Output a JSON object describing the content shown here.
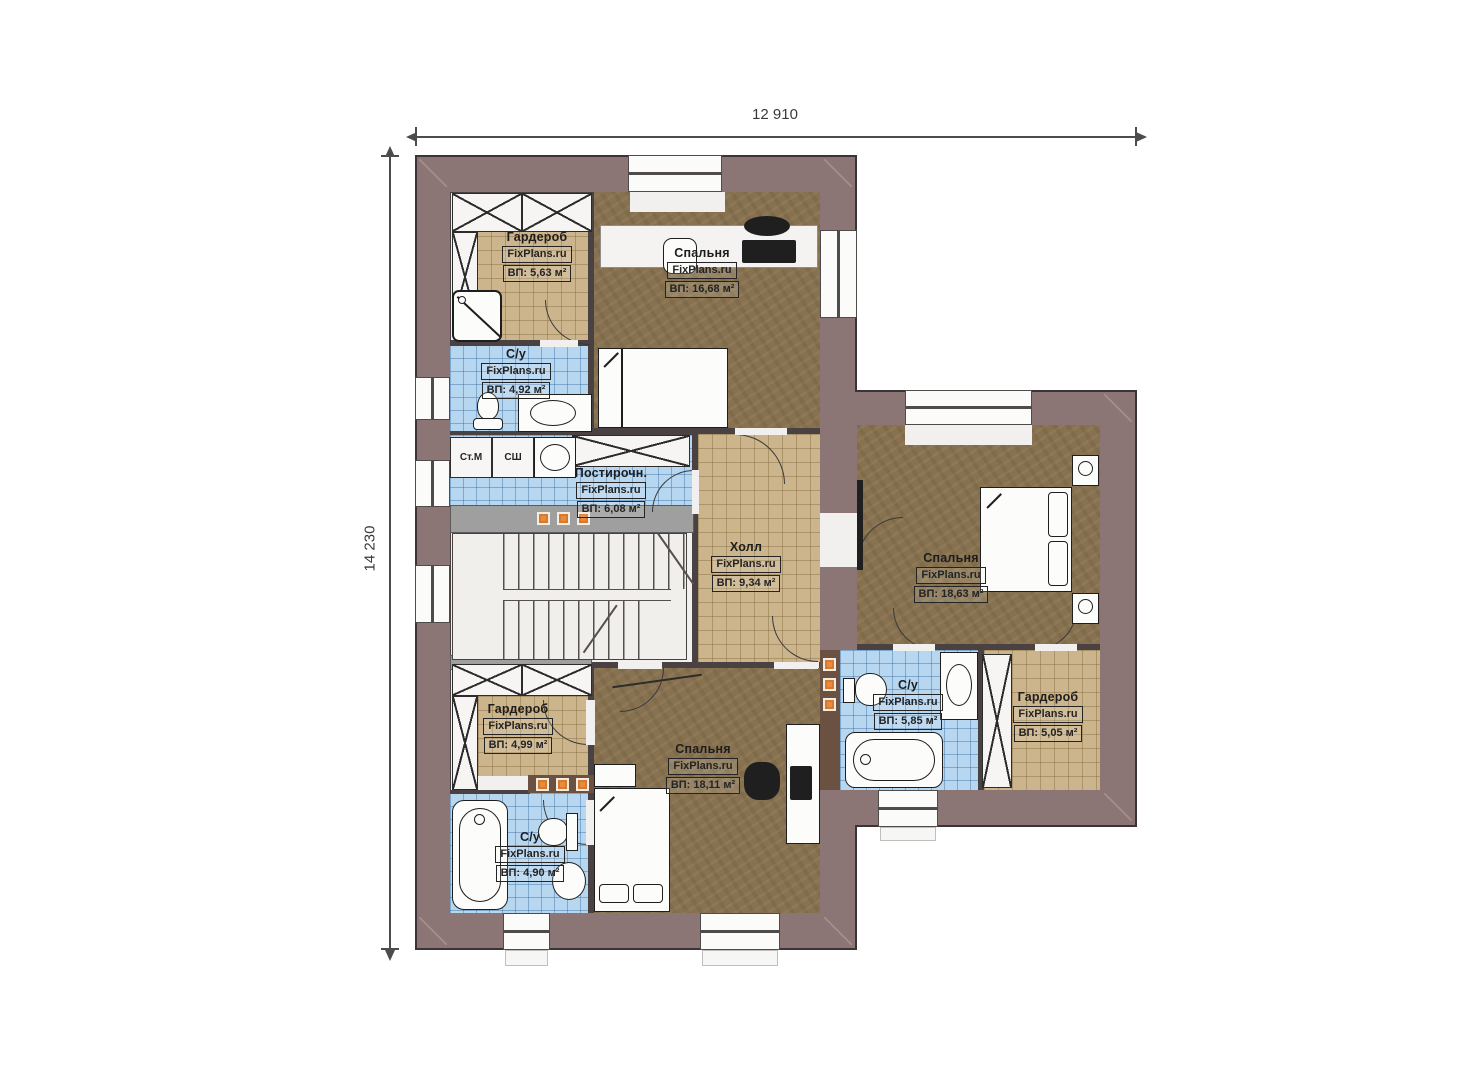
{
  "dimensions": {
    "width": "12 910",
    "height": "14 230"
  },
  "watermark": "FixPlans.ru",
  "rooms": {
    "wardrobe_tl": {
      "name": "Гардероб",
      "area": "ВП: 5,63 м²"
    },
    "bedroom_top": {
      "name": "Спальня",
      "area": "ВП: 16,68 м²"
    },
    "bath_tl": {
      "name": "С/у",
      "area": "ВП: 4,92 м²"
    },
    "laundry": {
      "name": "Постирочн.",
      "area": "ВП: 6,08 м²"
    },
    "hall": {
      "name": "Холл",
      "area": "ВП: 9,34 м²"
    },
    "bedroom_right": {
      "name": "Спальня",
      "area": "ВП: 18,63 м²"
    },
    "bath_right": {
      "name": "С/у",
      "area": "ВП: 5,85 м²"
    },
    "wardrobe_right": {
      "name": "Гардероб",
      "area": "ВП: 5,05 м²"
    },
    "wardrobe_bl": {
      "name": "Гардероб",
      "area": "ВП: 4,99 м²"
    },
    "bath_bl": {
      "name": "С/у",
      "area": "ВП: 4,90 м²"
    },
    "bedroom_bottom": {
      "name": "Спальня",
      "area": "ВП: 18,11 м²"
    }
  },
  "appliances": {
    "washer": "Ст.М",
    "dryer": "СШ"
  }
}
